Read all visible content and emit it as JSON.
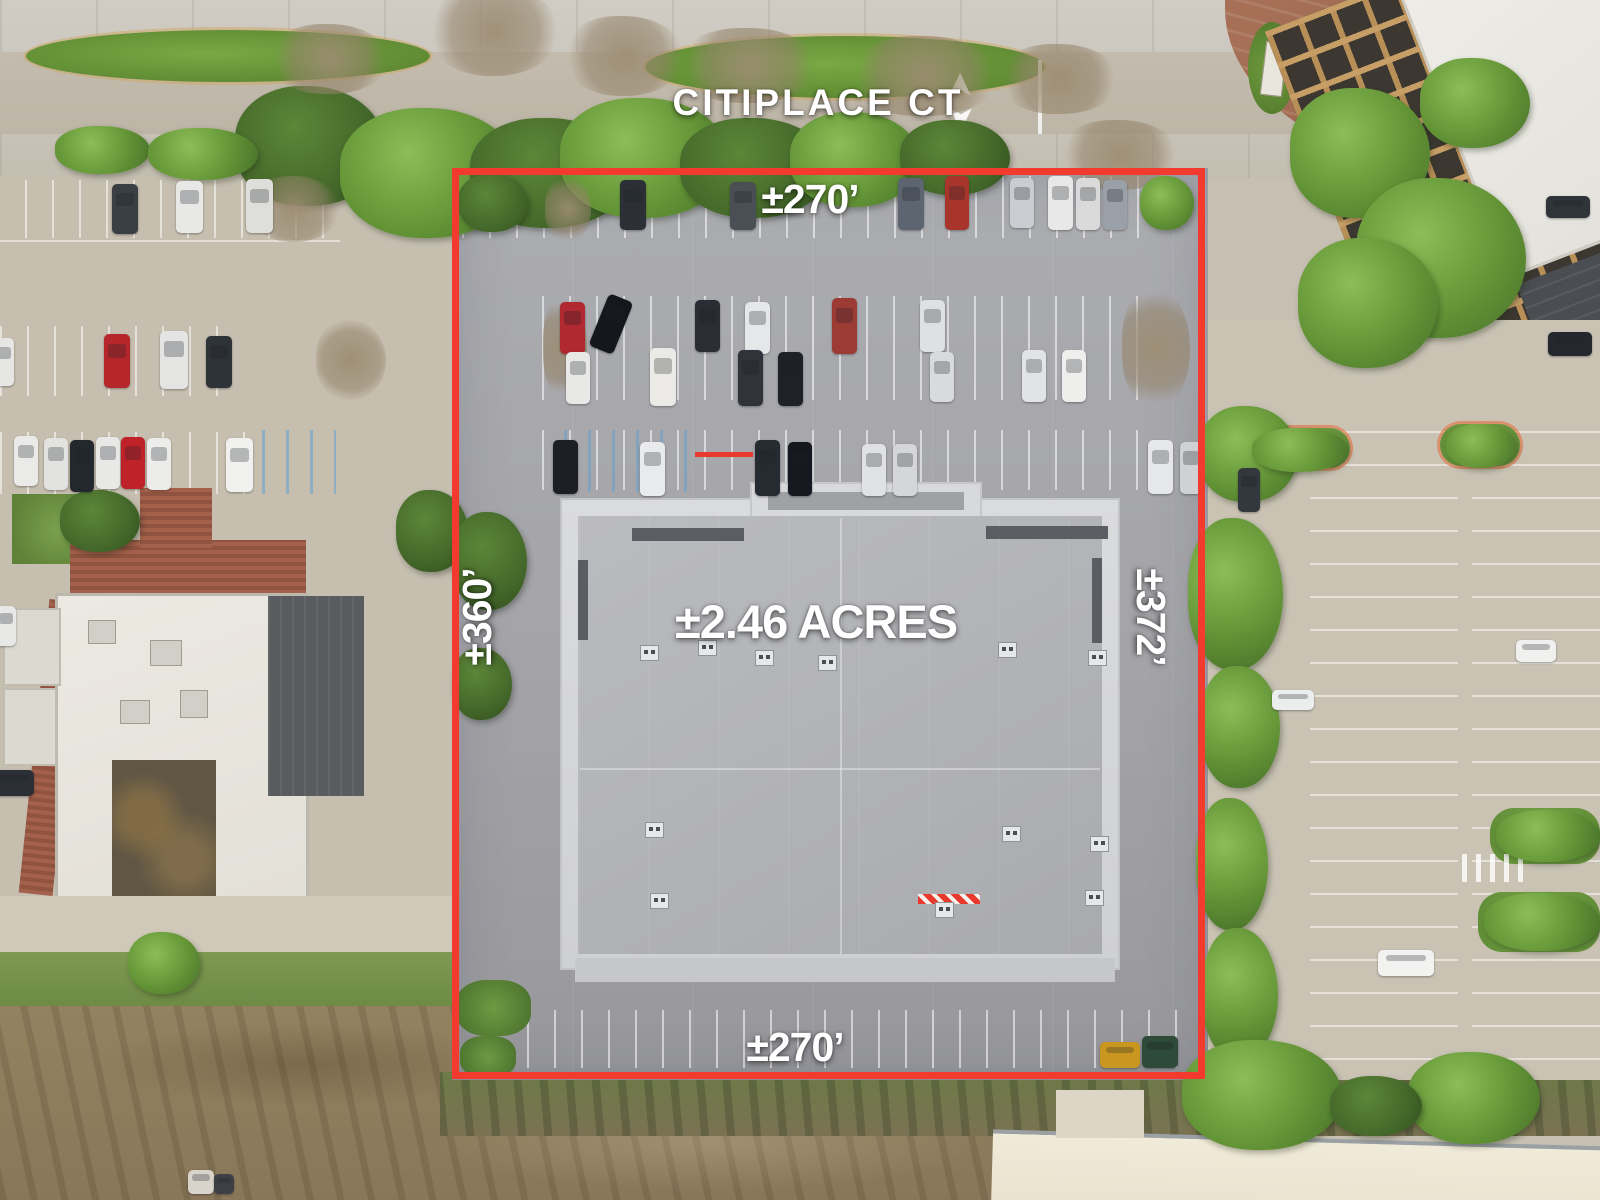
{
  "labels": {
    "street": "CITIPLACE CT",
    "top_dimension": "±270’",
    "bottom_dimension": "±270’",
    "left_dimension": "±360’",
    "right_dimension": "±372’",
    "area": "±2.46 ACRES"
  },
  "colors": {
    "boundary": "#f23b2e",
    "label_text": "#ffffff"
  },
  "icons": {
    "lane_arrow_up": "➤",
    "lane_arrow_down": "➤"
  },
  "scene": {
    "cars": [
      {
        "x": 112,
        "y": 184,
        "w": 26,
        "h": 50,
        "c": "#3a3f44"
      },
      {
        "x": 176,
        "y": 181,
        "w": 27,
        "h": 52,
        "c": "#e8e8e6"
      },
      {
        "x": 246,
        "y": 179,
        "w": 27,
        "h": 54,
        "c": "#dededb"
      },
      {
        "x": 104,
        "y": 334,
        "w": 26,
        "h": 54,
        "c": "#b6272c"
      },
      {
        "x": 160,
        "y": 331,
        "w": 28,
        "h": 58,
        "c": "#e4e4e2"
      },
      {
        "x": 206,
        "y": 336,
        "w": 26,
        "h": 52,
        "c": "#2e3338"
      },
      {
        "x": -8,
        "y": 338,
        "w": 22,
        "h": 48,
        "c": "#e6e6e4"
      },
      {
        "x": 14,
        "y": 436,
        "w": 24,
        "h": 50,
        "c": "#eaeae8"
      },
      {
        "x": 44,
        "y": 438,
        "w": 24,
        "h": 52,
        "c": "#e2e2e0"
      },
      {
        "x": 70,
        "y": 440,
        "w": 24,
        "h": 52,
        "c": "#23282e"
      },
      {
        "x": 96,
        "y": 437,
        "w": 24,
        "h": 52,
        "c": "#e8e8e6"
      },
      {
        "x": 121,
        "y": 437,
        "w": 24,
        "h": 52,
        "c": "#c0222a"
      },
      {
        "x": 147,
        "y": 438,
        "w": 24,
        "h": 52,
        "c": "#ececea"
      },
      {
        "x": 226,
        "y": 438,
        "w": 27,
        "h": 54,
        "c": "#f0f0ee"
      },
      {
        "x": -6,
        "y": 770,
        "w": 40,
        "h": 26,
        "c": "#2c3036"
      },
      {
        "x": -4,
        "y": 606,
        "w": 20,
        "h": 40,
        "c": "#e8e8e6"
      },
      {
        "x": 620,
        "y": 180,
        "w": 26,
        "h": 50,
        "c": "#2c3036"
      },
      {
        "x": 730,
        "y": 182,
        "w": 26,
        "h": 48,
        "c": "#4a4f55"
      },
      {
        "x": 898,
        "y": 178,
        "w": 26,
        "h": 52,
        "c": "#5d6670"
      },
      {
        "x": 945,
        "y": 176,
        "w": 24,
        "h": 54,
        "c": "#a8352c"
      },
      {
        "x": 1010,
        "y": 178,
        "w": 24,
        "h": 50,
        "c": "#c9ccd0"
      },
      {
        "x": 1048,
        "y": 176,
        "w": 25,
        "h": 54,
        "c": "#e8e8e8"
      },
      {
        "x": 1076,
        "y": 178,
        "w": 24,
        "h": 52,
        "c": "#dadada"
      },
      {
        "x": 1103,
        "y": 180,
        "w": 24,
        "h": 50,
        "c": "#9aa0a8"
      },
      {
        "x": 560,
        "y": 302,
        "w": 25,
        "h": 52,
        "c": "#b02830"
      },
      {
        "x": 598,
        "y": 296,
        "w": 26,
        "h": 56,
        "c": "#14181c",
        "r": 22
      },
      {
        "x": 695,
        "y": 300,
        "w": 25,
        "h": 52,
        "c": "#2a2e34"
      },
      {
        "x": 745,
        "y": 302,
        "w": 25,
        "h": 52,
        "c": "#e6e7e9"
      },
      {
        "x": 832,
        "y": 298,
        "w": 25,
        "h": 56,
        "c": "#9c3a34"
      },
      {
        "x": 920,
        "y": 300,
        "w": 25,
        "h": 52,
        "c": "#dfe0e2"
      },
      {
        "x": 566,
        "y": 352,
        "w": 24,
        "h": 52,
        "c": "#e8e8e6"
      },
      {
        "x": 650,
        "y": 348,
        "w": 26,
        "h": 58,
        "c": "#eceae6"
      },
      {
        "x": 738,
        "y": 350,
        "w": 25,
        "h": 56,
        "c": "#30343a"
      },
      {
        "x": 778,
        "y": 352,
        "w": 25,
        "h": 54,
        "c": "#1e2228"
      },
      {
        "x": 930,
        "y": 352,
        "w": 24,
        "h": 50,
        "c": "#d8dadc"
      },
      {
        "x": 1022,
        "y": 350,
        "w": 24,
        "h": 52,
        "c": "#e2e3e5"
      },
      {
        "x": 1062,
        "y": 350,
        "w": 24,
        "h": 52,
        "c": "#eeeeec"
      },
      {
        "x": 553,
        "y": 440,
        "w": 25,
        "h": 54,
        "c": "#1c2026"
      },
      {
        "x": 640,
        "y": 442,
        "w": 25,
        "h": 54,
        "c": "#e9eaec"
      },
      {
        "x": 755,
        "y": 440,
        "w": 25,
        "h": 56,
        "c": "#262b31"
      },
      {
        "x": 788,
        "y": 442,
        "w": 24,
        "h": 54,
        "c": "#15191f"
      },
      {
        "x": 862,
        "y": 444,
        "w": 24,
        "h": 52,
        "c": "#dfe1e3"
      },
      {
        "x": 893,
        "y": 444,
        "w": 24,
        "h": 52,
        "c": "#d4d6d8"
      },
      {
        "x": 1148,
        "y": 440,
        "w": 25,
        "h": 54,
        "c": "#e6e7e9"
      },
      {
        "x": 1180,
        "y": 442,
        "w": 22,
        "h": 52,
        "c": "#cfd1d3"
      },
      {
        "x": 1238,
        "y": 468,
        "w": 22,
        "h": 44,
        "c": "#33383e"
      },
      {
        "x": 1272,
        "y": 690,
        "w": 42,
        "h": 20,
        "c": "#eceded"
      },
      {
        "x": 1516,
        "y": 640,
        "w": 40,
        "h": 22,
        "c": "#f0f0ee"
      },
      {
        "x": 1378,
        "y": 950,
        "w": 56,
        "h": 26,
        "c": "#f2f2f0"
      },
      {
        "x": 1546,
        "y": 196,
        "w": 44,
        "h": 22,
        "c": "#2f343a"
      },
      {
        "x": 1548,
        "y": 332,
        "w": 44,
        "h": 24,
        "c": "#24282e"
      },
      {
        "x": 188,
        "y": 1170,
        "w": 26,
        "h": 24,
        "c": "#d8d4cc"
      },
      {
        "x": 214,
        "y": 1174,
        "w": 20,
        "h": 20,
        "c": "#3c4046"
      },
      {
        "x": 1100,
        "y": 1042,
        "w": 40,
        "h": 26,
        "c": "#c9971f"
      },
      {
        "x": 1142,
        "y": 1036,
        "w": 36,
        "h": 32,
        "c": "#2e4a38"
      }
    ],
    "trees": [
      {
        "x": 235,
        "y": 86,
        "w": 150,
        "h": 120,
        "t": "d"
      },
      {
        "x": 340,
        "y": 108,
        "w": 180,
        "h": 130,
        "t": "g"
      },
      {
        "x": 470,
        "y": 118,
        "w": 160,
        "h": 110,
        "t": "d"
      },
      {
        "x": 560,
        "y": 98,
        "w": 170,
        "h": 120,
        "t": "g"
      },
      {
        "x": 680,
        "y": 118,
        "w": 150,
        "h": 100,
        "t": "d"
      },
      {
        "x": 790,
        "y": 112,
        "w": 130,
        "h": 95,
        "t": "g"
      },
      {
        "x": 55,
        "y": 126,
        "w": 95,
        "h": 48,
        "t": "g"
      },
      {
        "x": 148,
        "y": 128,
        "w": 110,
        "h": 52,
        "t": "g"
      },
      {
        "x": 900,
        "y": 120,
        "w": 110,
        "h": 75,
        "t": "d"
      },
      {
        "x": 270,
        "y": 24,
        "w": 120,
        "h": 70,
        "t": "b"
      },
      {
        "x": 430,
        "y": -14,
        "w": 130,
        "h": 90,
        "t": "b"
      },
      {
        "x": 565,
        "y": 16,
        "w": 120,
        "h": 80,
        "t": "b"
      },
      {
        "x": 680,
        "y": 28,
        "w": 140,
        "h": 75,
        "t": "b"
      },
      {
        "x": 850,
        "y": 36,
        "w": 150,
        "h": 80,
        "t": "b"
      },
      {
        "x": 1000,
        "y": 44,
        "w": 120,
        "h": 70,
        "t": "b"
      },
      {
        "x": 1060,
        "y": 120,
        "w": 120,
        "h": 70,
        "t": "b"
      },
      {
        "x": 60,
        "y": 490,
        "w": 80,
        "h": 62,
        "t": "d"
      },
      {
        "x": 396,
        "y": 490,
        "w": 72,
        "h": 82,
        "t": "d"
      },
      {
        "x": 452,
        "y": 512,
        "w": 75,
        "h": 98,
        "t": "d"
      },
      {
        "x": 452,
        "y": 648,
        "w": 60,
        "h": 72,
        "t": "d"
      },
      {
        "x": 458,
        "y": 174,
        "w": 70,
        "h": 58,
        "t": "d"
      },
      {
        "x": 545,
        "y": 176,
        "w": 46,
        "h": 66,
        "t": "b"
      },
      {
        "x": 1140,
        "y": 176,
        "w": 54,
        "h": 54,
        "t": "g"
      },
      {
        "x": 543,
        "y": 294,
        "w": 44,
        "h": 108,
        "t": "b"
      },
      {
        "x": 1122,
        "y": 286,
        "w": 68,
        "h": 124,
        "t": "b"
      },
      {
        "x": 1198,
        "y": 406,
        "w": 100,
        "h": 96,
        "t": "g"
      },
      {
        "x": 1188,
        "y": 518,
        "w": 95,
        "h": 152,
        "t": "g"
      },
      {
        "x": 1200,
        "y": 666,
        "w": 80,
        "h": 122,
        "t": "g"
      },
      {
        "x": 1196,
        "y": 798,
        "w": 72,
        "h": 132,
        "t": "g"
      },
      {
        "x": 1202,
        "y": 928,
        "w": 76,
        "h": 132,
        "t": "g"
      },
      {
        "x": 1208,
        "y": 1046,
        "w": 66,
        "h": 70,
        "t": "g"
      },
      {
        "x": 1290,
        "y": 88,
        "w": 140,
        "h": 130,
        "t": "g"
      },
      {
        "x": 1356,
        "y": 178,
        "w": 170,
        "h": 160,
        "t": "g"
      },
      {
        "x": 1298,
        "y": 238,
        "w": 140,
        "h": 130,
        "t": "g"
      },
      {
        "x": 1420,
        "y": 58,
        "w": 110,
        "h": 90,
        "t": "g"
      },
      {
        "x": 1496,
        "y": 810,
        "w": 104,
        "h": 52,
        "t": "g"
      },
      {
        "x": 1484,
        "y": 893,
        "w": 116,
        "h": 58,
        "t": "g"
      },
      {
        "x": 1182,
        "y": 1040,
        "w": 160,
        "h": 110,
        "t": "g"
      },
      {
        "x": 1408,
        "y": 1052,
        "w": 132,
        "h": 92,
        "t": "g"
      },
      {
        "x": 1330,
        "y": 1076,
        "w": 92,
        "h": 60,
        "t": "d"
      },
      {
        "x": 128,
        "y": 932,
        "w": 72,
        "h": 62,
        "t": "g"
      },
      {
        "x": 250,
        "y": 176,
        "w": 90,
        "h": 66,
        "t": "b"
      },
      {
        "x": 316,
        "y": 320,
        "w": 70,
        "h": 80,
        "t": "b"
      },
      {
        "x": 1446,
        "y": 424,
        "w": 70,
        "h": 44,
        "t": "g"
      },
      {
        "x": 1252,
        "y": 428,
        "w": 96,
        "h": 44,
        "t": "g"
      }
    ],
    "units": [
      {
        "x": 640,
        "y": 645
      },
      {
        "x": 698,
        "y": 640
      },
      {
        "x": 755,
        "y": 650
      },
      {
        "x": 818,
        "y": 655
      },
      {
        "x": 998,
        "y": 642
      },
      {
        "x": 1088,
        "y": 650
      },
      {
        "x": 645,
        "y": 822
      },
      {
        "x": 1002,
        "y": 826
      },
      {
        "x": 1090,
        "y": 836
      },
      {
        "x": 650,
        "y": 893
      },
      {
        "x": 1085,
        "y": 890
      },
      {
        "x": 935,
        "y": 902
      }
    ]
  }
}
